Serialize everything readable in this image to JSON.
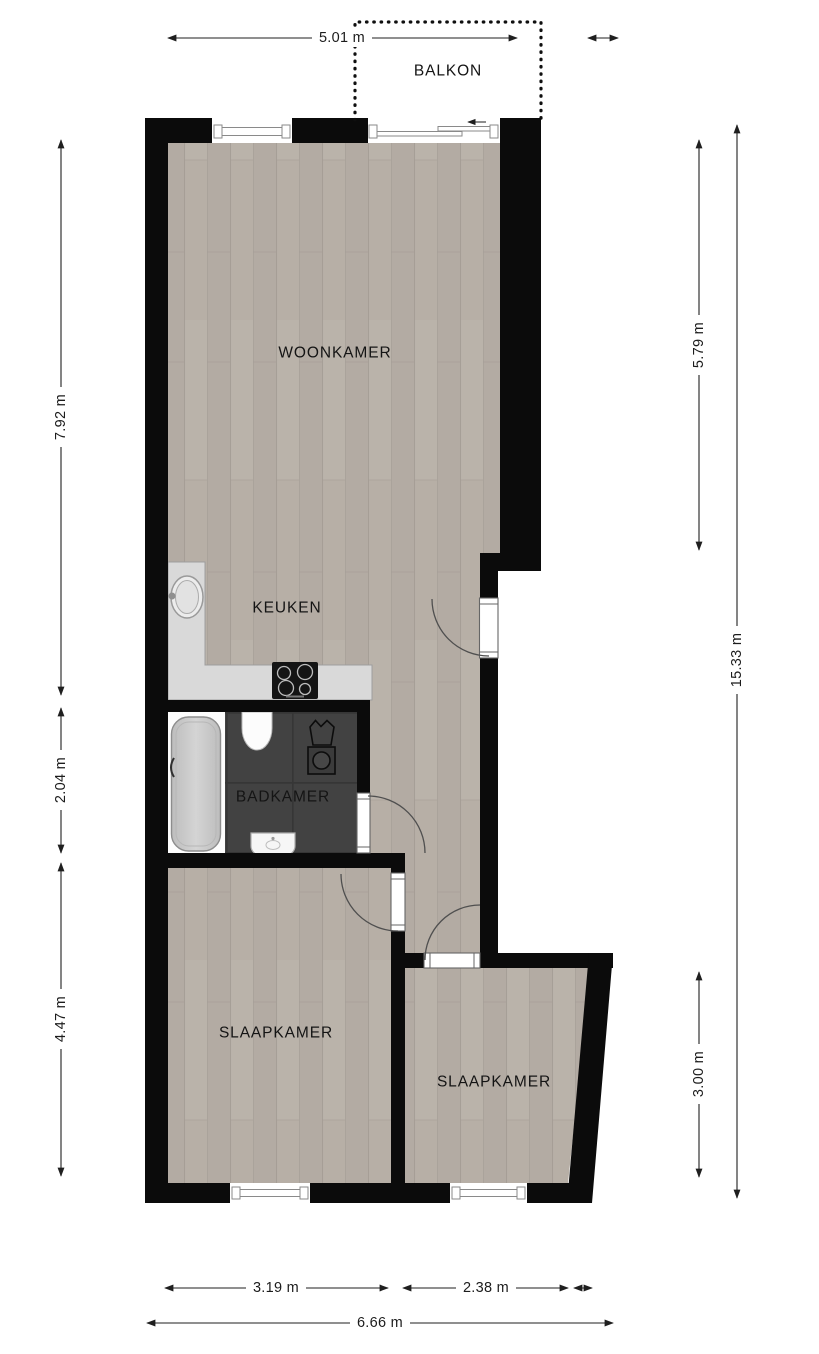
{
  "floorplan": {
    "rooms": {
      "balkon": "BALKON",
      "woonkamer": "WOONKAMER",
      "keuken": "KEUKEN",
      "badkamer": "BADKAMER",
      "slaapkamer_left": "SLAAPKAMER",
      "slaapkamer_right": "SLAAPKAMER"
    },
    "dimensions": {
      "balcony_width": "5.01 m",
      "living_height": "7.92 m",
      "bathroom_height": "2.04 m",
      "bedroom_left_height": "4.47 m",
      "right_upper_height": "5.79 m",
      "bedroom_right_height": "3.00 m",
      "total_height": "15.33 m",
      "bedroom_left_width": "3.19 m",
      "bedroom_right_width": "2.38 m",
      "total_width": "6.66 m"
    },
    "icons": [
      "kitchen-sink",
      "cooktop",
      "bathtub",
      "toilet",
      "laundry-basket",
      "washing-machine",
      "washbasin",
      "door-swing",
      "window",
      "sliding-door-arrow",
      "dimension-arrow"
    ],
    "colors": {
      "wall": "#0b0b0b",
      "wood_floor": "#b7afa6",
      "tile_floor": "#424242",
      "counter": "#d9d9d9",
      "dimension": "#1f1f1f",
      "background": "#ffffff"
    }
  }
}
